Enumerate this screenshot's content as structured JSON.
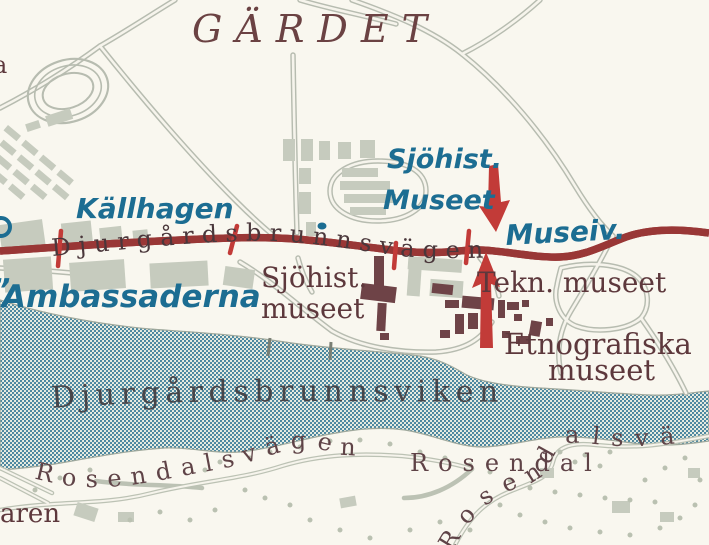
{
  "map_type": "scanned-city-map",
  "city_area": "Stockholm / Djurgården area",
  "colors": {
    "land": "#f9f7ef",
    "water_dot": "#47849e",
    "road_red": "#bf4a43",
    "road_red_casing": "#993736",
    "road_gray": "#b7bcb0",
    "building_gray": "#c6cbbe",
    "building_dark": "#6e4347",
    "label_blue": "#1c6d92",
    "label_dark": "#5d383c",
    "annotation_red": "#c23b38"
  },
  "labels": {
    "district": "GÄRDET",
    "kallhagen": "Källhagen",
    "main_road": "Djurgårdsbrunnsvägen",
    "stop_line1": "Sjöhist.",
    "stop_line2": "Museet",
    "museivagen": "Museiv.",
    "quote_fragment": "”",
    "ambassaderna": "Ambassaderna",
    "sjohist_line1": "Sjöhist.",
    "sjohist_line2": "museet",
    "tekniska": "Tekn. museet",
    "etnografiska_line1": "Etnografiska",
    "etnografiska_line2": "museet",
    "water_name": "Djurgårdsbrunnsviken",
    "rosendalsvagen_west": "Rosendalsvägen",
    "rosendal": "Rosendal",
    "rosendalsvagen_east": "Rosendalsvä",
    "edge_fragment_left": "aren",
    "edge_fragment_top": "a"
  }
}
